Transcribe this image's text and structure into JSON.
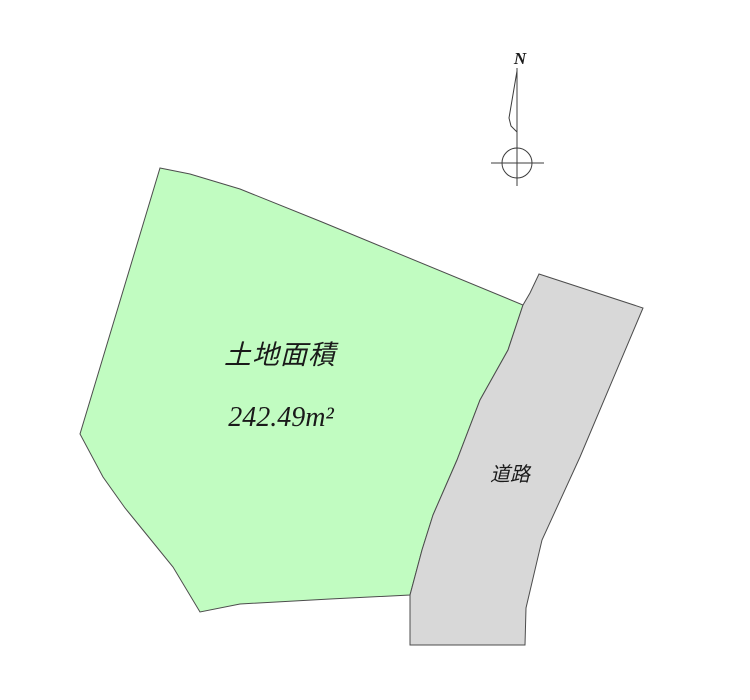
{
  "parcel": {
    "label": "土地面積",
    "area": "242.49m²"
  },
  "road": {
    "label": "道路"
  },
  "compass": {
    "north_label": "N"
  },
  "colors": {
    "parcel_fill": "#c1fcc1",
    "road_fill": "#d8d8d8",
    "outline": "#4c4c4c",
    "text": "#1a1a1a"
  }
}
